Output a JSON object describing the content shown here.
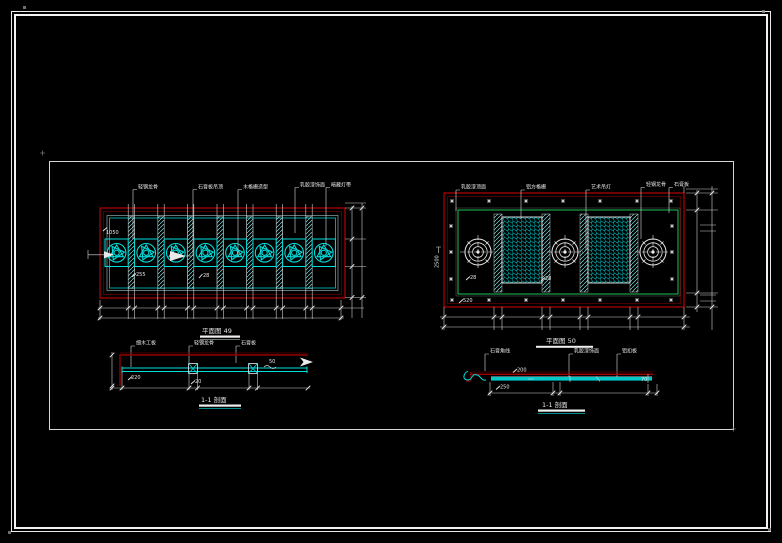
{
  "drawing": {
    "left_plan": {
      "title": "平面图 49",
      "leaders": [
        "轻钢龙骨",
        "石膏板吊顶",
        "木格栅造型",
        "乳胶漆饰面",
        "暗藏灯带"
      ],
      "labels": {
        "a": "1050",
        "b": "255",
        "c": "28"
      }
    },
    "left_section": {
      "title": "1-1 剖面",
      "leaders": [
        "细木工板",
        "轻钢龙骨",
        "石膏板"
      ],
      "labels": {
        "a": "220",
        "b": "20",
        "c": "50"
      }
    },
    "right_plan": {
      "title": "平面图 50",
      "leaders": [
        "乳胶漆顶面",
        "铝方格栅",
        "艺术吊灯",
        "轻钢龙骨",
        "石膏板"
      ],
      "labels": {
        "a": "2500",
        "b": "28",
        "c": "28",
        "d": "520"
      }
    },
    "right_section": {
      "title": "1-1 剖面",
      "leaders": [
        "石膏角线",
        "乳胶漆饰面",
        "铝扣板"
      ],
      "labels": {
        "a": "200",
        "b": "250",
        "c": "70"
      }
    },
    "colors": {
      "line_red": "#a80000",
      "dark_red": "#600000",
      "cyan": "#00dede",
      "teal": "#00a0a0",
      "green": "#18a04a",
      "white": "#e6e6e6"
    }
  }
}
